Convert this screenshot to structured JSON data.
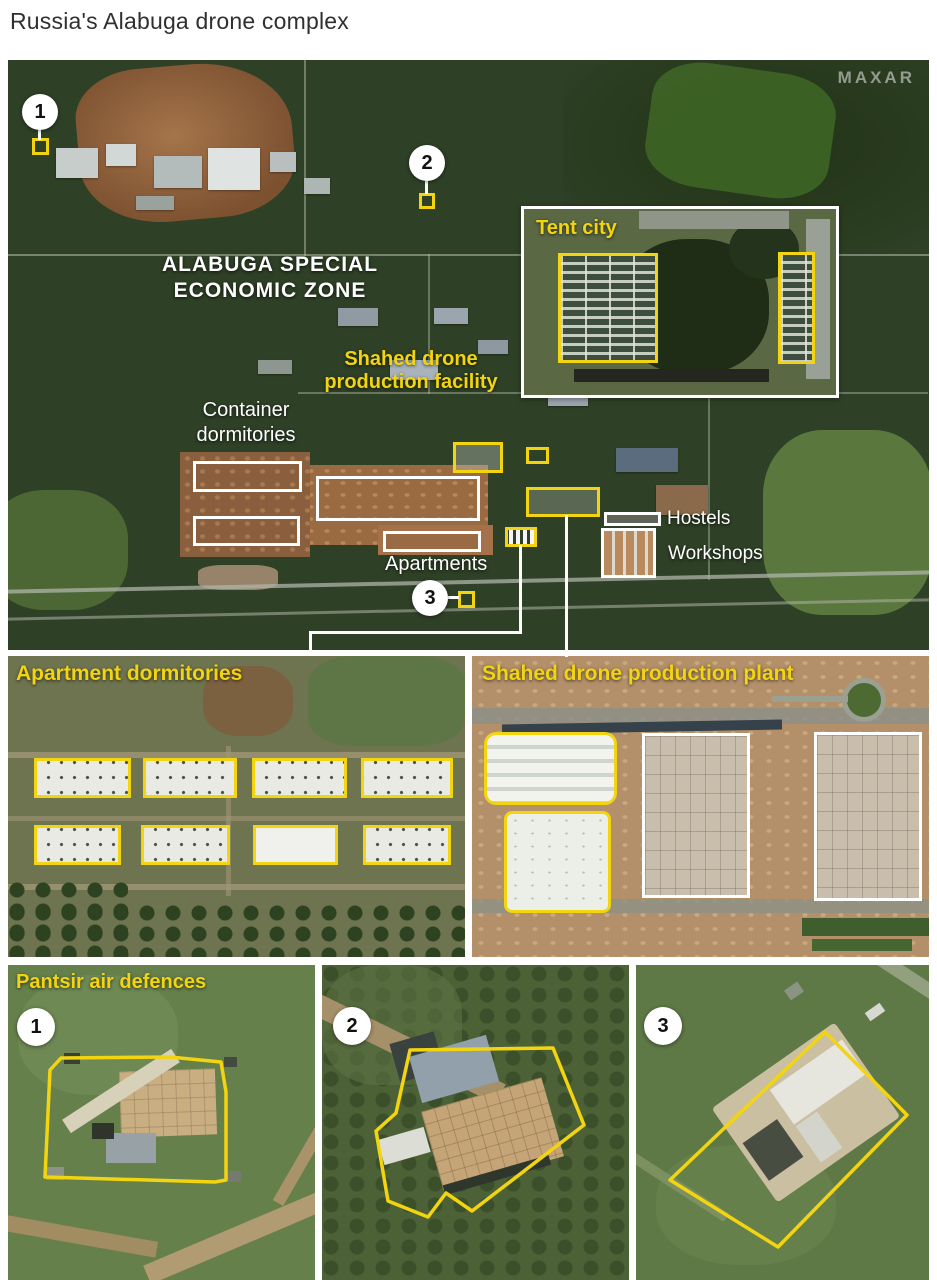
{
  "title": "Russia's Alabuga drone complex",
  "colors": {
    "annotation_yellow": "#f2d410",
    "annotation_white": "#ffffff"
  },
  "main_map": {
    "watermark": "MAXAR",
    "zone_label_line1": "ALABUGA SPECIAL",
    "zone_label_line2": "ECONOMIC ZONE",
    "tent_city_label": "Tent city",
    "shahed_label_line1": "Shahed drone",
    "shahed_label_line2": "production facility",
    "container_label_line1": "Container",
    "container_label_line2": "dormitories",
    "apartments_label": "Apartments",
    "hostels_label": "Hostels",
    "workshops_label": "Workshops",
    "markers": [
      "1",
      "2",
      "3"
    ]
  },
  "panels": {
    "apartment_dormitories": {
      "label": "Apartment dormitories"
    },
    "shahed_plant": {
      "label": "Shahed drone production plant"
    },
    "pantsir": {
      "label": "Pantsir air defences",
      "markers": [
        "1",
        "2",
        "3"
      ]
    }
  }
}
